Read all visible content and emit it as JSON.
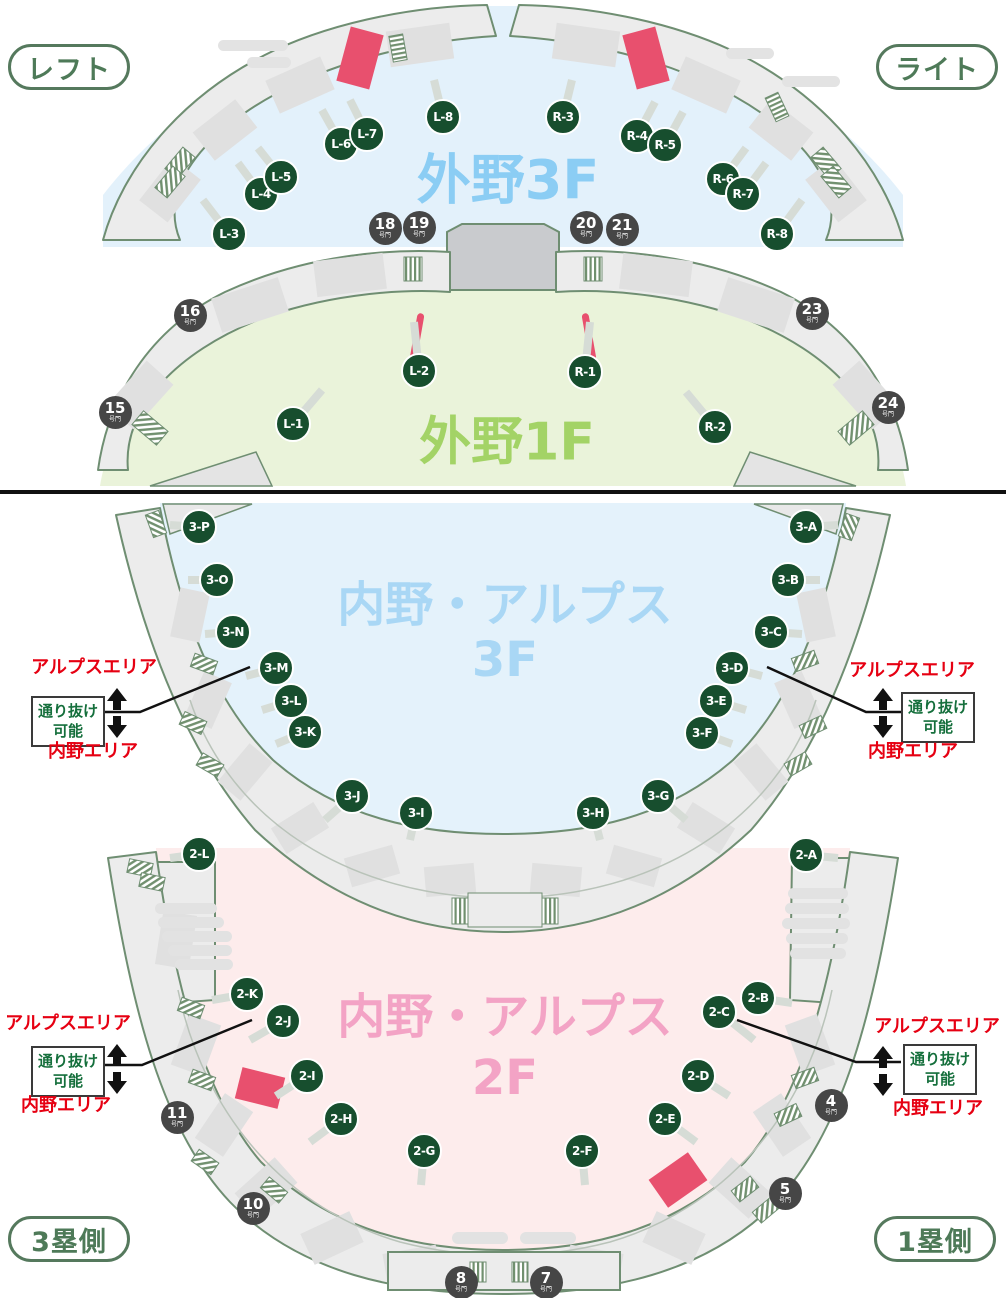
{
  "pills": {
    "top_left": "レフト",
    "top_right": "ライト",
    "bottom_left": "3塁側",
    "bottom_right": "1塁側"
  },
  "titles": {
    "outfield_3f": "外野3F",
    "outfield_1f": "外野1F",
    "infield_3f_line1": "内野・アルプス",
    "infield_3f_line2": "3F",
    "infield_2f_line1": "内野・アルプス",
    "infield_2f_line2": "2F"
  },
  "area_labels": {
    "alps": "アルプスエリア",
    "infield": "内野エリア",
    "pass_line1": "通り抜け",
    "pass_line2": "可能"
  },
  "gate_suffix": "号門",
  "markers_outfield": [
    "L-1",
    "L-2",
    "L-3",
    "L-4",
    "L-5",
    "L-6",
    "L-7",
    "L-8",
    "R-1",
    "R-2",
    "R-3",
    "R-4",
    "R-5",
    "R-6",
    "R-7",
    "R-8"
  ],
  "markers_3f": [
    "3-A",
    "3-B",
    "3-C",
    "3-D",
    "3-E",
    "3-F",
    "3-G",
    "3-H",
    "3-I",
    "3-J",
    "3-K",
    "3-L",
    "3-M",
    "3-N",
    "3-O",
    "3-P"
  ],
  "markers_2f": [
    "2-A",
    "2-B",
    "2-C",
    "2-D",
    "2-E",
    "2-F",
    "2-G",
    "2-H",
    "2-I",
    "2-J",
    "2-K",
    "2-L"
  ],
  "gates": [
    "15",
    "16",
    "18",
    "19",
    "20",
    "21",
    "23",
    "24",
    "11",
    "10",
    "8",
    "7",
    "5",
    "4"
  ],
  "colors": {
    "marker_green": "#174e2e",
    "gate_gray": "#464646",
    "pill_green": "#55795d",
    "label_red": "#e60012",
    "pass_green": "#156f3c",
    "accent_red": "#e8506e",
    "outfield3f_bg": "#e3f1fb",
    "outfield3f_title": "#8bcdf4",
    "outfield1f_bg": "#eaf3da",
    "outfield1f_title": "#a3d366",
    "infield3f_bg": "#e4f2fb",
    "infield3f_title": "#a9d7f5",
    "infield2f_bg": "#fdecec",
    "infield2f_title": "#f3a3c5",
    "concourse": "#ececec",
    "concourse_line": "#6f8e72"
  }
}
